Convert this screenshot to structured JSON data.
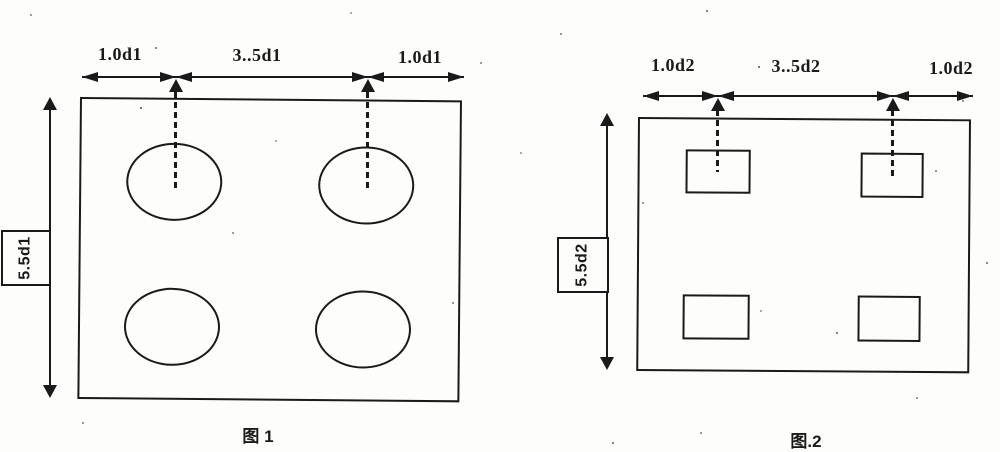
{
  "colors": {
    "ink": "#1a1a1a",
    "paper": "#fdfdfb"
  },
  "figure1": {
    "caption": "图 1",
    "dims": {
      "left": "1.0d1",
      "middle": "3..5d1",
      "right": "1.0d1"
    },
    "side": "5.5d1",
    "hole_shape": "ellipse",
    "hole_count": 4
  },
  "figure2": {
    "caption": "图.2",
    "dims": {
      "left": "1.0d2",
      "middle": "3..5d2",
      "right": "1.0d2"
    },
    "side": "5.5d2",
    "hole_shape": "rectangle",
    "hole_count": 4
  }
}
